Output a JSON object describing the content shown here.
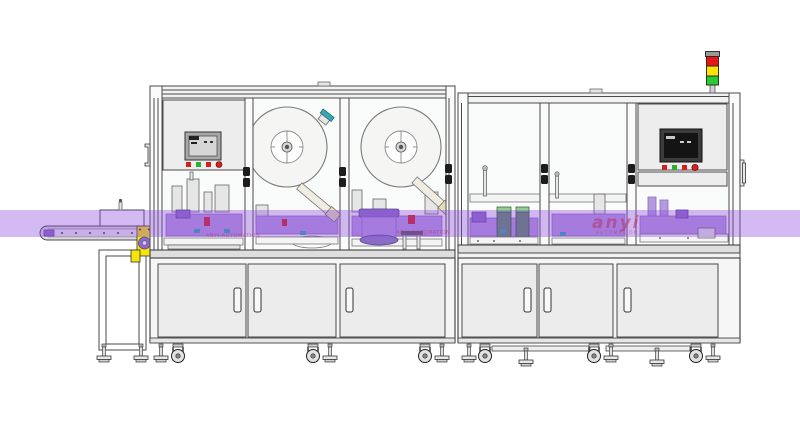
{
  "scene": {
    "description": "CAD line rendering of a two-cabinet automation machine with conveyor, label reels, HMI panels and signal tower",
    "band_region": {
      "y_top": 210,
      "y_bottom": 237
    }
  },
  "watermark": {
    "brand": "anyi",
    "caption": "AUTOMATION",
    "small_text": "ANYI AUTOMATION"
  },
  "signal_tower": {
    "lights": [
      "red",
      "yellow",
      "green"
    ]
  },
  "left_hmi": {
    "buttons": [
      "red",
      "green",
      "red",
      "red"
    ]
  },
  "right_hmi": {
    "buttons": [
      "red",
      "green",
      "red",
      "red"
    ]
  },
  "colors": {
    "band": "#8e49dd",
    "machinery_purple": "#b49ade",
    "machinery_purple_dark": "#8a6cc8",
    "outline": "#4a4a4a",
    "panel_face": "#ededed",
    "glass": "#fafbfb",
    "door_face": "#ececec",
    "red": "#d42020",
    "green": "#2fae35",
    "teal": "#2fa7b4",
    "yellow": "#f6e50a",
    "tower_red": "#e81515",
    "tower_yellow": "#ffe20a",
    "tower_green": "#27cc33",
    "tower_cap": "#9a9a9a",
    "screen_dark": "#141414",
    "screen_light": "#d6d6d6",
    "station_green_body": "#5d8b66",
    "station_green_cap": "#8fd08a"
  }
}
